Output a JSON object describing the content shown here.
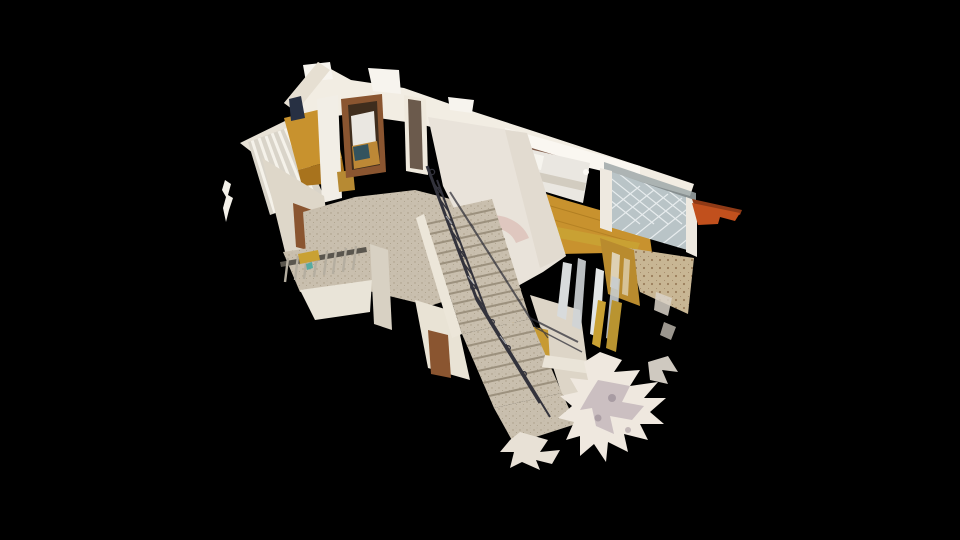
{
  "app": {
    "name": "3d-tour-viewer",
    "view_mode": "dollhouse",
    "background": "#000000"
  },
  "scene": {
    "subject": "cutaway dollhouse scan of a two-story house",
    "regions": [
      "left-bedroom-with-curtain",
      "doorway-to-small-bedroom",
      "upper-hallway",
      "grand-staircase",
      "wrought-iron-railing",
      "right-bedroom-with-bed",
      "lattice-terrace",
      "orange-roof-beam",
      "tiled-terrace-floor",
      "balcony-ledge",
      "lower-landing",
      "scan-mesh-fragments",
      "floating-scan-artifact"
    ]
  },
  "colors": {
    "background": "#000000",
    "wall": "#f2ede3",
    "wall_bright": "#fbf9f4",
    "wall_shadow": "#ddd5c7",
    "wall_dark": "#c9c0b0",
    "center_wall": "#e9e3da",
    "pink_arc": "#dcbfb8",
    "floor_terrazzo": "#c9bfae",
    "terrazzo_speck": "#a2967f",
    "stair_line": "#9c917e",
    "floor_wood": "#c8922e",
    "wood_dark": "#9a6b16",
    "wood_light": "#e2aa45",
    "gold": "#c9a133",
    "gold_furniture": "#b98b2e",
    "bed_white": "#eae7e1",
    "bed_shadow": "#d2ccc0",
    "pillow": "#f6f4ee",
    "headboard_brown": "#7d5a48",
    "rug_blue": "#33535e",
    "door_brown": "#8a5530",
    "door_dark": "#6b5a4c",
    "door_gold": "#c79a33",
    "door_opening": "#3f2d1d",
    "railing_iron": "#33333c",
    "railing_glint": "#c9ccd2",
    "lattice": "#b9c4c7",
    "lattice_line": "#edf1f2",
    "roofline_gray": "#9fa8a9",
    "beam_orange": "#c1501d",
    "beam_dark": "#8f3a16",
    "tile": "#c8b694",
    "tile_dot": "#8a6a49",
    "curtain": "#d9d4c9",
    "curtain_stripe": "#f5f2ea",
    "chair_navy": "#273043",
    "silver": "#d6dadb",
    "mesh_light": "#efe8df",
    "mesh_shadow": "#b3a3ad",
    "mesh_dark": "#8d7f8a",
    "balcony_rail": "#5a564e",
    "slat_gray": "#b5aea0"
  }
}
